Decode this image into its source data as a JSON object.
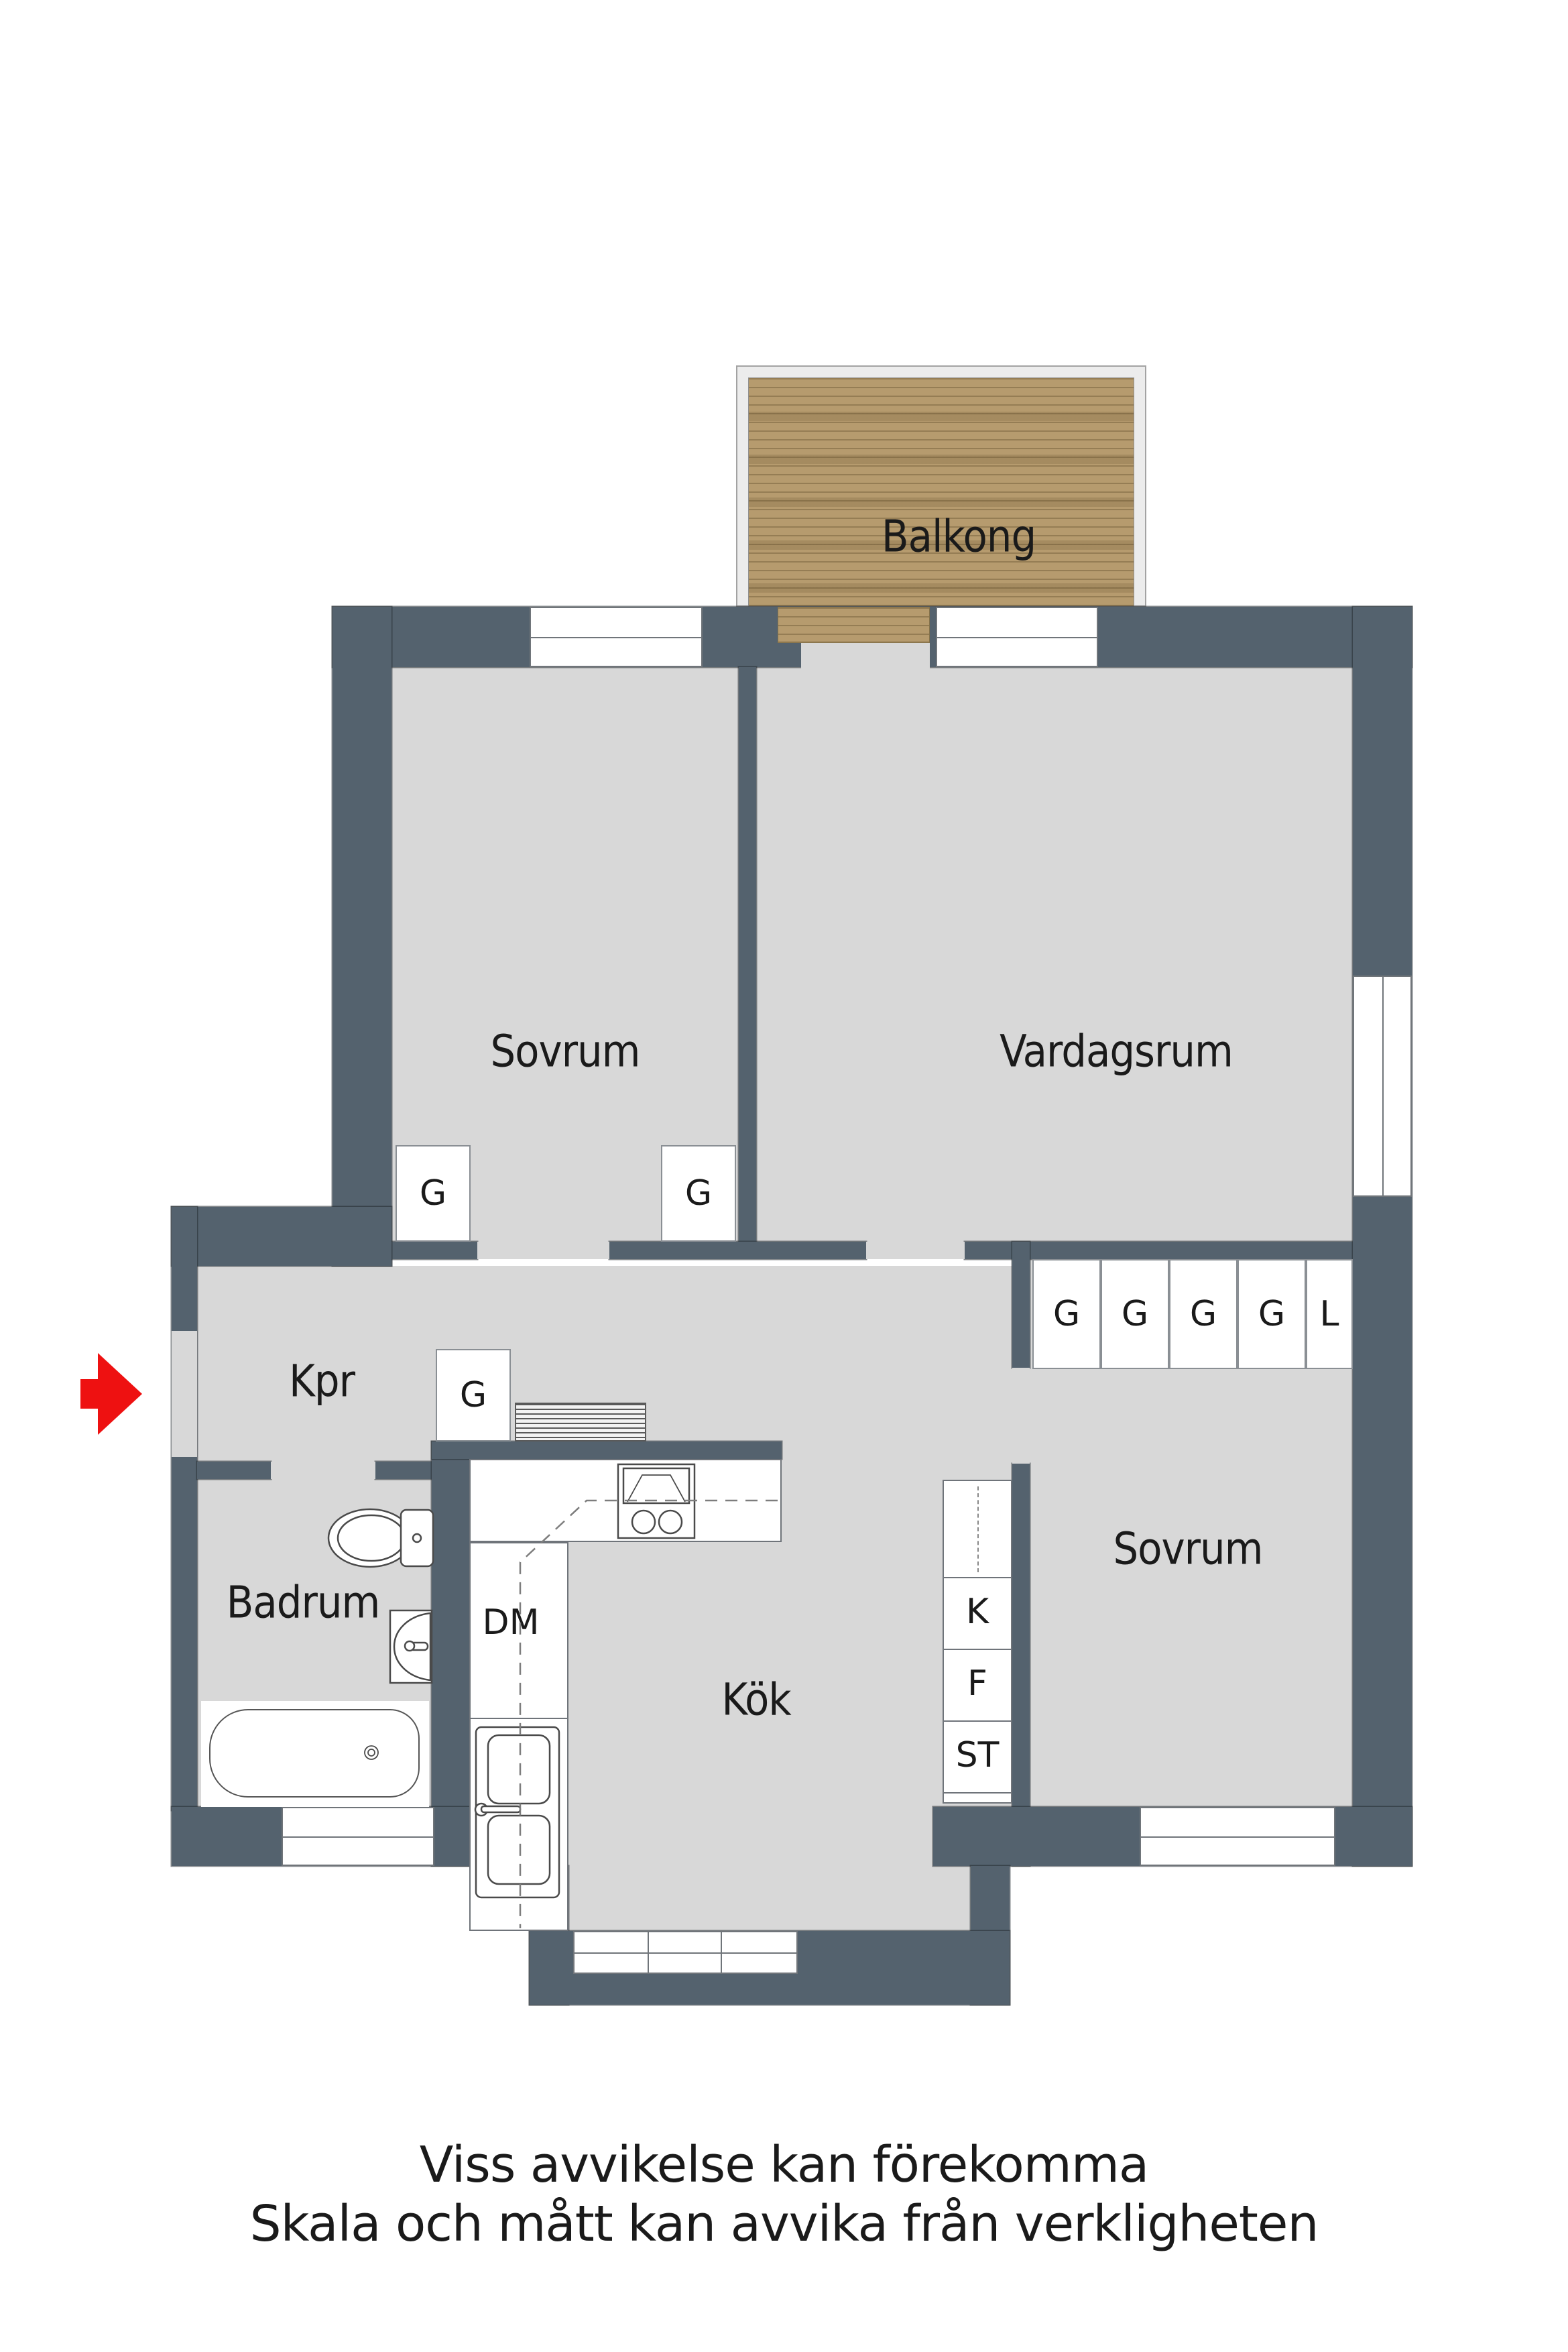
{
  "rooms": {
    "balcony": "Balkong",
    "bedroom1": "Sovrum",
    "living_room": "Vardagsrum",
    "hallway": "Kpr",
    "bathroom": "Badrum",
    "kitchen": "Kök",
    "bedroom2": "Sovrum"
  },
  "closets": {
    "bedroom1": [
      "G",
      "G"
    ],
    "hallway": [
      "G"
    ],
    "bedroom2": [
      "G",
      "G",
      "G",
      "G",
      "L"
    ]
  },
  "appliances": {
    "dishwasher": "DM",
    "fridge": "K",
    "freezer": "F",
    "cleaning_closet": "ST"
  },
  "disclaimer": {
    "line1": "Viss avvikelse kan förekomma",
    "line2": "Skala och mått kan avvika från verkligheten"
  },
  "colors": {
    "wall": "#54626E",
    "floor": "#D8D8D8",
    "wood": "#B69B6E",
    "wood_stripe": "#7E6C4C",
    "frame": "#ECECEC",
    "outline": "#70757A",
    "accent_red": "#EE1111",
    "text": "#1A1A1A"
  }
}
